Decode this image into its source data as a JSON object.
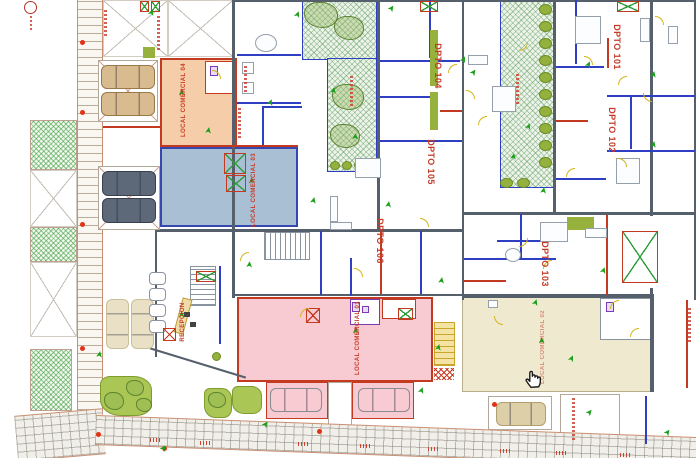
{
  "plan": {
    "units": {
      "u101": "DPTO 101",
      "u102": "DPTO 102",
      "u103": "DPTO 103",
      "u104": "DPTO 104",
      "u105": "DPTO 105",
      "u106": "DPTO 106"
    },
    "locals": {
      "l01": "LOCAL COMERCIAL 01",
      "l02": "LOCAL COMERCIAL 02",
      "l03": "LOCAL COMERCIAL 03",
      "l04": "LOCAL COMERCIAL 04"
    },
    "rooms": {
      "reception": "RECEPCION"
    },
    "icons": {
      "green_arrow_glyph": "➤",
      "hand_cursor": "hand-cursor-icon"
    },
    "colors": {
      "local01": "#f7cbd1",
      "local02": "#efe9d0",
      "local03": "#a9bfd3",
      "local04": "#f5cda9",
      "label_red": "#c63a28",
      "wall_slate": "#55606c",
      "wall_blue": "#2f3fc4",
      "arrow_green": "#18a018",
      "door_yellow": "#d2b41c",
      "shrub_olive": "#96b23c"
    }
  }
}
